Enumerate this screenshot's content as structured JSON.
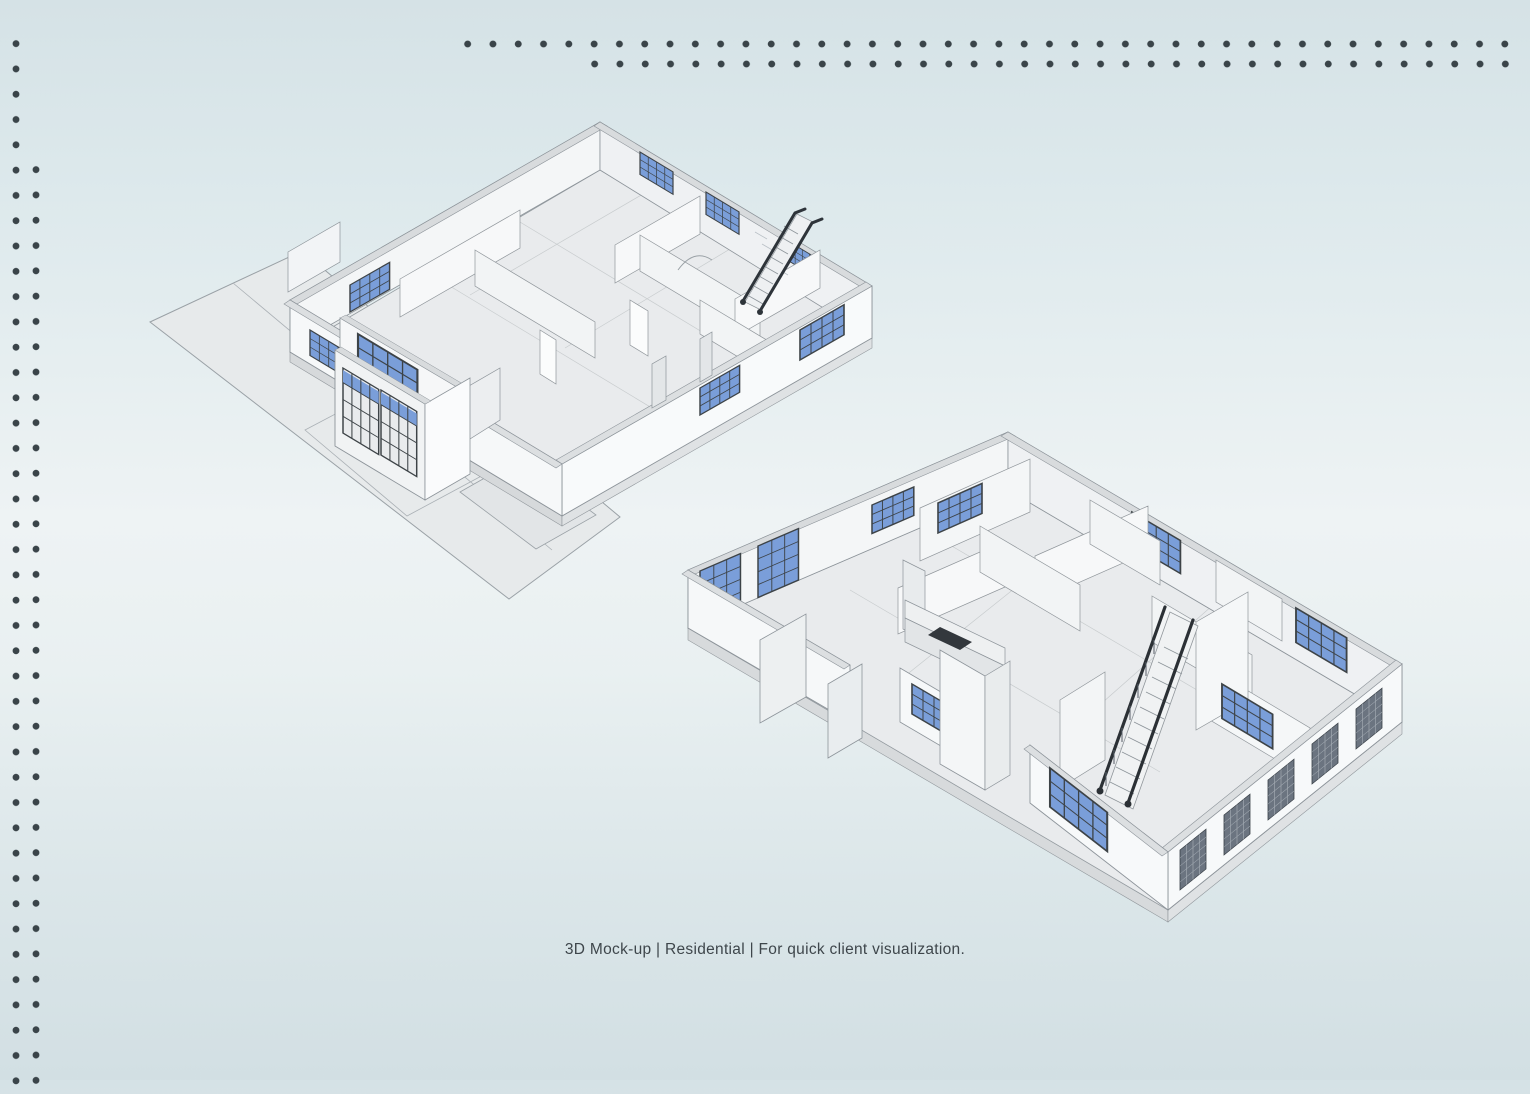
{
  "page": {
    "background": {
      "top": "#d5e2e6",
      "middle": "#eef3f4",
      "bottom": "#d2dfe3"
    },
    "dot_pattern_color": "#3a4449"
  },
  "caption": {
    "text": "3D Mock-up | Residential | For quick client visualization.",
    "color": "#3e464b"
  },
  "models": {
    "rear_view": {
      "label": "3D residential floor-plan mock-up, rear perspective with driveway, garage doors and staircase",
      "colors": {
        "walls": "#f4f6f7",
        "wall_caps": "#d8dbdd",
        "floor": "#e9ebed",
        "ground": "#e7eaeb",
        "window_glass": "#7a9ed9",
        "window_frame": "#3d4347",
        "stair_rail": "#2e343a",
        "edges": "#8d949a"
      }
    },
    "front_view": {
      "label": "3D residential floor-plan mock-up, front perspective with curved staircase, kitchen and window wall",
      "colors": {
        "walls": "#f4f6f7",
        "wall_caps": "#d8dbdd",
        "floor": "#e9ebed",
        "window_glass": "#7a9ed9",
        "window_frame": "#3d4347",
        "dark_window_panel": "#6b7480",
        "stair_rail": "#2b3035",
        "edges": "#8d949a"
      }
    }
  }
}
